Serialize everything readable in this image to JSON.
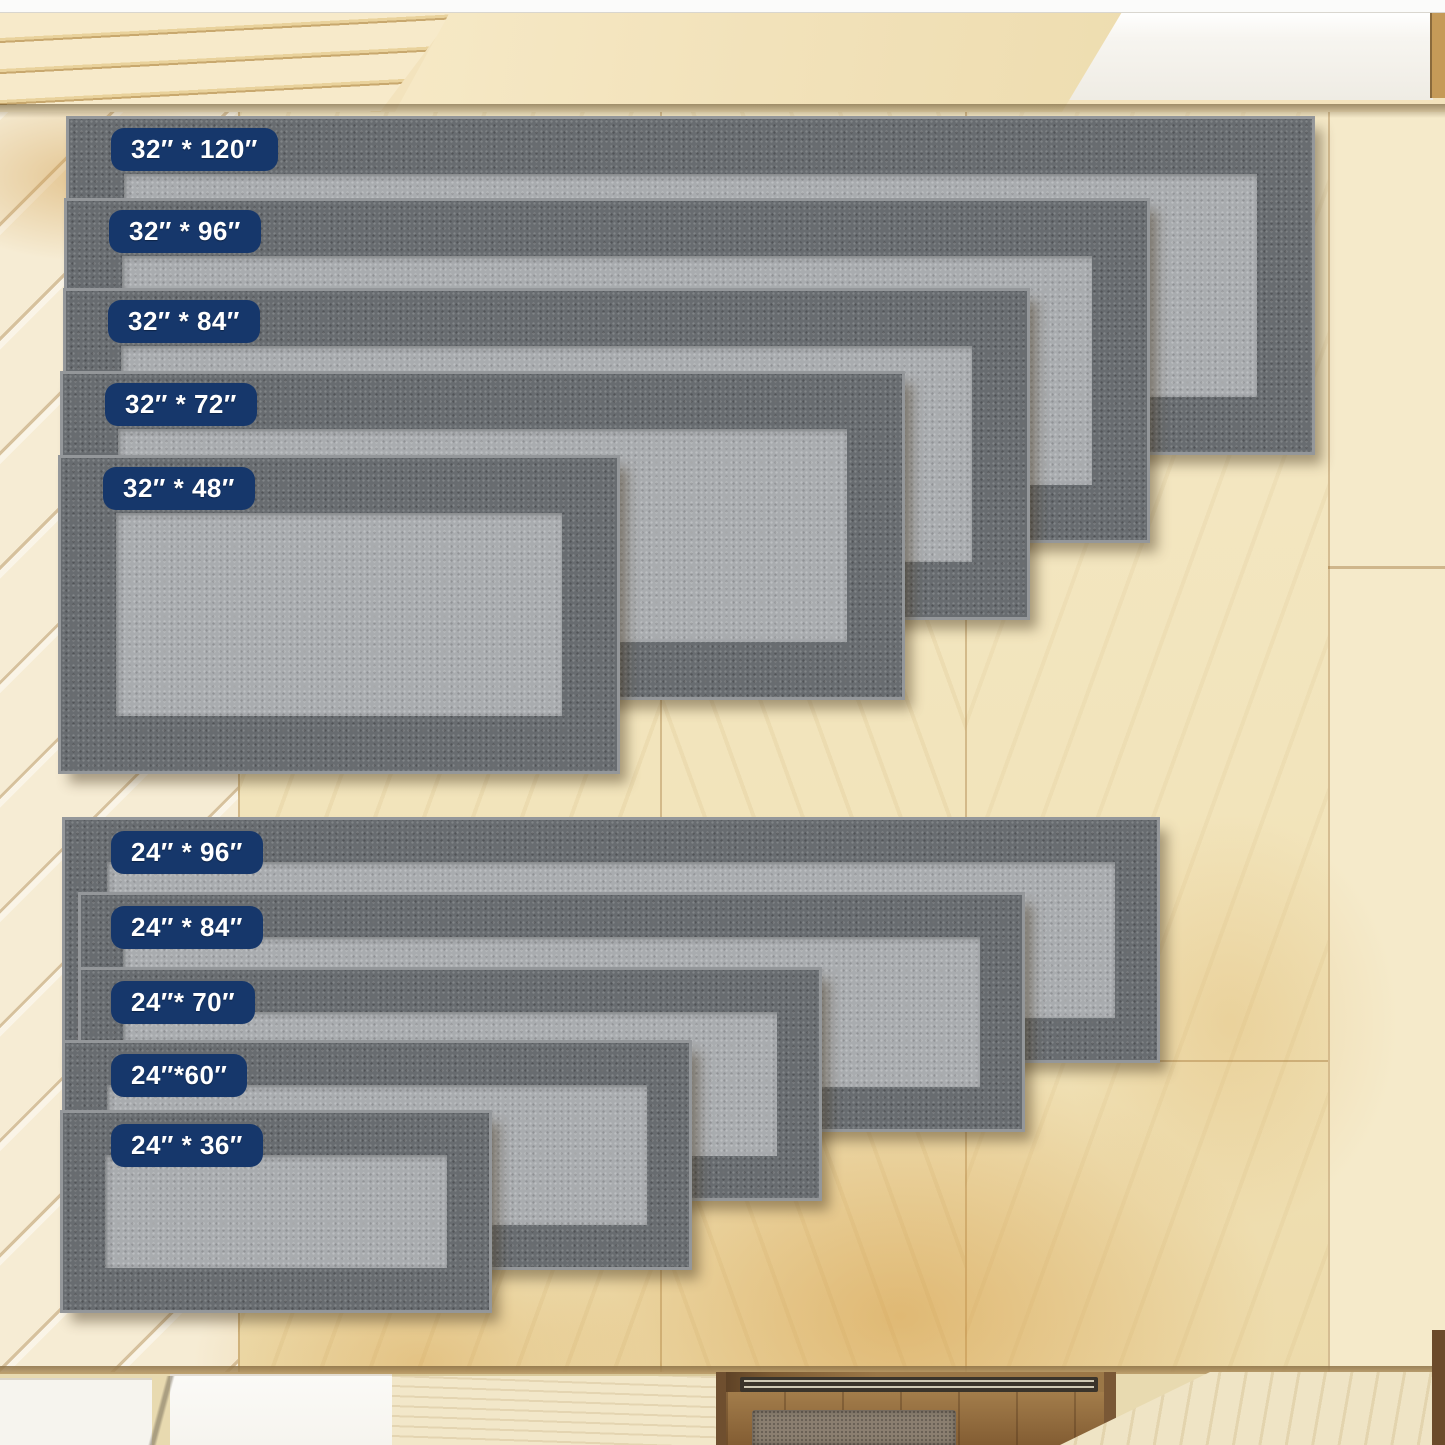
{
  "meta": {
    "description": "Top-view product photo of gray bordered runner rugs laid out on a light wood kitchen floor, each rug tagged with a navy size badge",
    "setting": "kitchen wood floor seen from above with cabinets at top, white appliance, recessed entryway at bottom"
  },
  "rug_groups": [
    {
      "name": "32-inch wide runners",
      "rugs": [
        {
          "size": "32″ * 120″",
          "width_in": 32,
          "length_in": 120
        },
        {
          "size": "32″ * 96″",
          "width_in": 32,
          "length_in": 96
        },
        {
          "size": "32″ * 84″",
          "width_in": 32,
          "length_in": 84
        },
        {
          "size": "32″ * 72″",
          "width_in": 32,
          "length_in": 72
        },
        {
          "size": "32″ * 48″",
          "width_in": 32,
          "length_in": 48
        }
      ]
    },
    {
      "name": "24-inch wide runners",
      "rugs": [
        {
          "size": "24″ * 96″",
          "width_in": 24,
          "length_in": 96
        },
        {
          "size": "24″ * 84″",
          "width_in": 24,
          "length_in": 84
        },
        {
          "size": "24″* 70″",
          "width_in": 24,
          "length_in": 70
        },
        {
          "size": "24″*60″",
          "width_in": 24,
          "length_in": 60
        },
        {
          "size": "24″ * 36″",
          "width_in": 24,
          "length_in": 36
        }
      ]
    }
  ],
  "colors": {
    "label_bg": "#16376b",
    "label_text": "#ffffff",
    "rug_border": "#686c70",
    "rug_center": "#a9acaf",
    "rug_binding": "#94979a",
    "floor_base": "#f2e4bb",
    "cabinet_wood": "#f3e3bd",
    "appliance_white": "#f7f5f0",
    "appliance_slot": "#33302a",
    "recess_wood": "#9b7747",
    "recess_frame": "#6f4f2f",
    "entry_mat": "#8b7f70",
    "platform": "#efe4c5",
    "white_slab": "#f6f4ee",
    "top_strip": "#fbfbfa"
  }
}
